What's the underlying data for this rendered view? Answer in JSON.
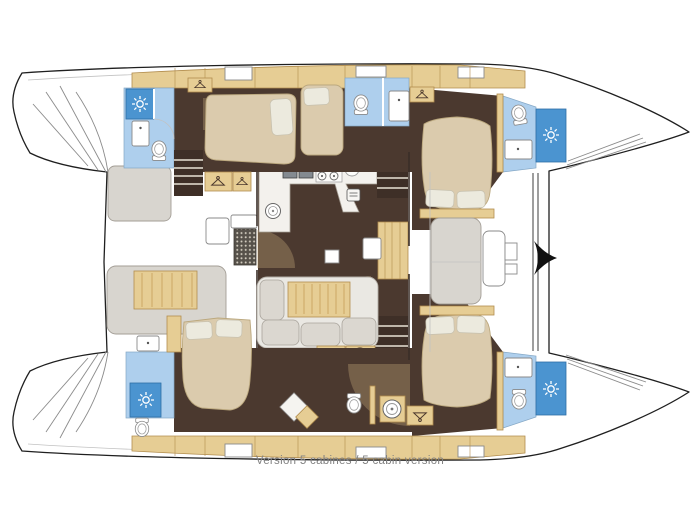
{
  "caption": "Version 5 cabines / 5 cabin version",
  "title": "Catamaran 5-cabin layout floor plan",
  "colors": {
    "wood": "#e6cd94",
    "wood_stroke": "#b28d4e",
    "floor": "#4b392f",
    "stairs": "#3e2f27",
    "bed": "#dbcbad",
    "bed_stroke": "#bba87e",
    "pillow": "#eceade",
    "wet": "#aecfed",
    "shower": "#4b94d0",
    "bench": "#d8d5cf",
    "counter": "#f3f1ed",
    "sofa": "#eae8e3",
    "cushion": "#dbd7d0",
    "caption": "#828282"
  },
  "icons": {
    "shower_head": "sun-rays",
    "toilet": "oval-bowl",
    "washbasin": "rect-basin",
    "stove": "four-burners",
    "galley_sink": "double-square",
    "wardrobe": "clothes-hanger",
    "washing_machine": "drum-circle",
    "deck_grate": "dot-grid",
    "mast_fitting": "black-chevron"
  }
}
